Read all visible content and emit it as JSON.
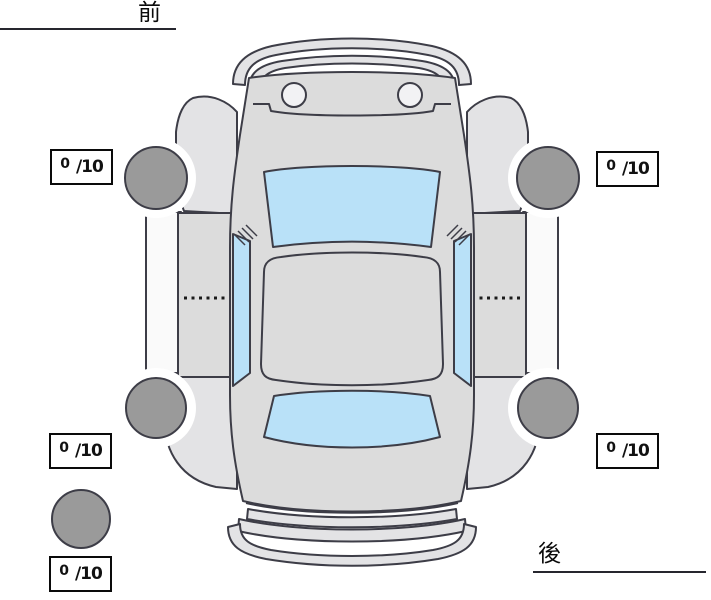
{
  "orientation_labels": {
    "front": "前",
    "rear": "後"
  },
  "tire_scores": {
    "front_left": {
      "value": "0",
      "max": "/10"
    },
    "front_right": {
      "value": "0",
      "max": "/10"
    },
    "rear_left": {
      "value": "0",
      "max": "/10"
    },
    "rear_right": {
      "value": "0",
      "max": "/10"
    },
    "spare": {
      "value": "0",
      "max": "/10"
    }
  },
  "colors": {
    "car_body": "#dcdcdc",
    "fender": "#e3e3e5",
    "sill": "#fafafa",
    "glass": "#b9e1f8",
    "headlight": "#f2f2f4",
    "tire": "#9a9a9a",
    "outline": "#3d3d47"
  }
}
